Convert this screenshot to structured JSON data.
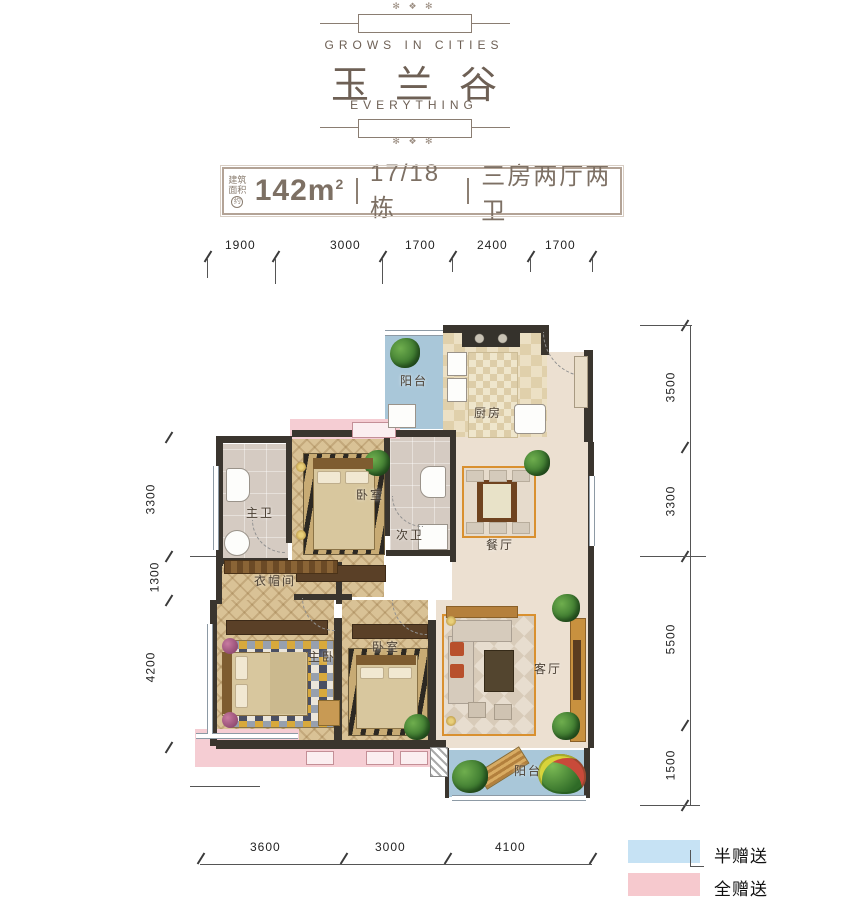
{
  "header": {
    "tagline_top": "GROWS IN CITIES",
    "logo_name": "玉兰谷",
    "tagline_bottom": "EVERYTHING"
  },
  "icons": {
    "ornament_top": "✻ ❖ ✻",
    "ornament_bottom": "✻ ❖ ✻"
  },
  "info_bar": {
    "area_label_line1": "建筑",
    "area_label_line2": "面积",
    "area_label_circle": "约",
    "area_value": "142m",
    "area_superscript": "2",
    "building": "17/18栋",
    "layout": "三房两厅两卫"
  },
  "dimensions": {
    "top": [
      "1900",
      "3000",
      "1700",
      "2400",
      "1700"
    ],
    "left": [
      "3300",
      "1300",
      "4200"
    ],
    "right": [
      "3500",
      "3300",
      "5500",
      "1500"
    ],
    "bottom": [
      "3600",
      "3000",
      "4100"
    ]
  },
  "rooms": {
    "balcony_top": "阳台",
    "kitchen": "厨房",
    "master_bath": "主卫",
    "bedroom_mid": "卧室",
    "second_bath": "次卫",
    "dining": "餐厅",
    "cloakroom": "衣帽间",
    "master_bedroom": "主卧",
    "bedroom_2": "卧室",
    "living": "客厅",
    "balcony_bottom": "阳台"
  },
  "legend": {
    "items": [
      {
        "label": "半赠送",
        "color": "#c6e2f4"
      },
      {
        "label": "全赠送",
        "color": "#f6c9ce"
      }
    ]
  },
  "colors": {
    "balcony_blue": "#a9c7d9",
    "full_gift_pink": "#f5cdd3",
    "wall_dark": "#3a352e",
    "brand_brown": "#6e6055",
    "rug_border_orange": "#d9902f"
  }
}
